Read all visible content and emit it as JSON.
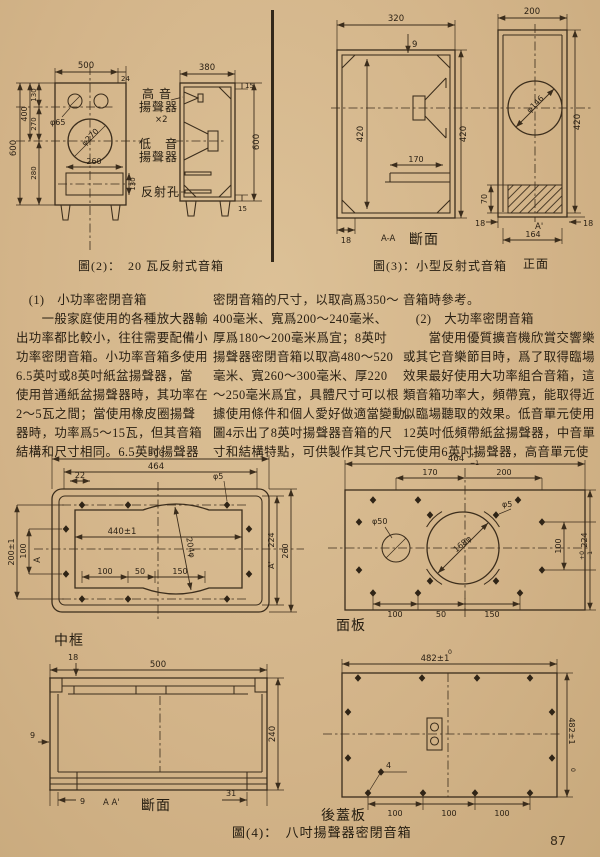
{
  "page": {
    "number": "87"
  },
  "fig2": {
    "caption": "圖(2)：　20 瓦反射式音箱",
    "front": {
      "dim_width": "500",
      "dim_thick": "24",
      "dim_height": "600",
      "dim_400": "400",
      "dim_130": "130",
      "dim_270": "270",
      "dim_280": "280",
      "tweeter_dia": "φ65",
      "woofer_dia": "φ270",
      "port_width": "260",
      "port_height": "130"
    },
    "side": {
      "dim_depth": "380",
      "dim_top15": "15",
      "dim_height": "600",
      "dim_bot15": "15",
      "tweeter_line1": "高 音",
      "tweeter_line2": "揚聲器",
      "tweeter_count": "×2",
      "woofer_line1": "低　音",
      "woofer_line2": "揚聲器",
      "port_label": "反射孔"
    }
  },
  "fig3": {
    "caption": "圖(3)：小型反射式音箱",
    "section": {
      "dim_width": "320",
      "dim_panel": "9",
      "dim_inner_h": "420",
      "dim_outer_h": "420",
      "dim_shelf": "170",
      "dim_wall": "18",
      "mark": "A-A",
      "label": "斷面"
    },
    "front": {
      "dim_width": "200",
      "speaker_dia": "φ146",
      "dim_height": "420",
      "dim_port_h": "70",
      "dim_wall_left": "18",
      "dim_wall_right": "18",
      "mark": "A'",
      "dim_port_w": "164",
      "label": "正面"
    }
  },
  "text": {
    "col1": [
      "　(1)　小功率密閉音箱",
      "　　一般家庭使用的各種放大器輸",
      "出功率都比較小，往往需要配備小",
      "功率密閉音箱。小功率音箱多使用",
      "6.5英吋或8英吋紙盆揚聲器，當",
      "使用普通紙盆揚聲器時，其功率在",
      "2～5瓦之間；當使用橡皮圈揚聲",
      "器時，功率爲5～15瓦，但其音箱",
      "結構和尺寸相同。6.5英吋揚聲器"
    ],
    "col2": [
      "密閉音箱的尺寸，以取高爲350～",
      "400毫米、寬爲200～240毫米、",
      "厚爲180～200毫米爲宜；8英吋",
      "揚聲器密閉音箱以取高480～520",
      "毫米、寬260～300毫米、厚220",
      "～250毫米爲宜，具體尺寸可以根",
      "據使用條件和個人愛好做適當變動。",
      "圖4示出了8英吋揚聲器音箱的尺",
      "寸和結構特點，可供製作其它尺寸"
    ],
    "col3": [
      "音箱時參考。",
      "　(2)　大功率密閉音箱",
      "　　當使用優質擴音機欣賞交響樂",
      "或其它音樂節目時，爲了取得臨場",
      "效果最好使用大功率組合音箱，這",
      "類音箱功率大，頻帶寬，能取得近",
      "似臨場聽取的效果。低音單元使用",
      "12英吋低頻帶紙盆揚聲器，中音單",
      "元使用6英吋揚聲器，高音單元使"
    ]
  },
  "fig4": {
    "caption": "圖(4)：　八吋揚聲器密閉音箱",
    "midframe": {
      "label": "中框",
      "dim_500": "500",
      "dim_464": "464",
      "dim_22": "22",
      "hole_dia": "φ5",
      "dim_440": "440±1",
      "arc_dia": "204φ",
      "dim_100b": "100",
      "dim_50": "50",
      "dim_150": "150",
      "dim_200": "200±1",
      "dim_100l": "100",
      "mark_a": "A",
      "dim_224": "224",
      "mark_ap": "A'",
      "dim_260": "260"
    },
    "panel": {
      "label": "面板",
      "dim_464": "464",
      "tol_top": "+0",
      "tol_bot": "−1",
      "dim_170": "170",
      "dim_200": "200",
      "hole50": "φ50",
      "hole5": "φ5",
      "speaker_dia": "168φ",
      "dim_224": "224",
      "tol2_top": "+0",
      "tol2_bot": "−1",
      "dim_100r": "100",
      "dim_100b": "100",
      "dim_50b": "50",
      "dim_150b": "150"
    },
    "section": {
      "label": "斷面",
      "dim_18": "18",
      "dim_500": "500",
      "dim_9l": "9",
      "dim_240": "240",
      "dim_9b": "9",
      "mark": "A  A'",
      "dim_31": "31"
    },
    "back": {
      "label": "後蓋板",
      "tol_top": "0",
      "dim_482t": "482±1",
      "dim_482r": "482±1",
      "tol_r": "0",
      "hole_dia": "4",
      "dim_100a": "100",
      "dim_100b": "100",
      "dim_100c": "100"
    }
  }
}
